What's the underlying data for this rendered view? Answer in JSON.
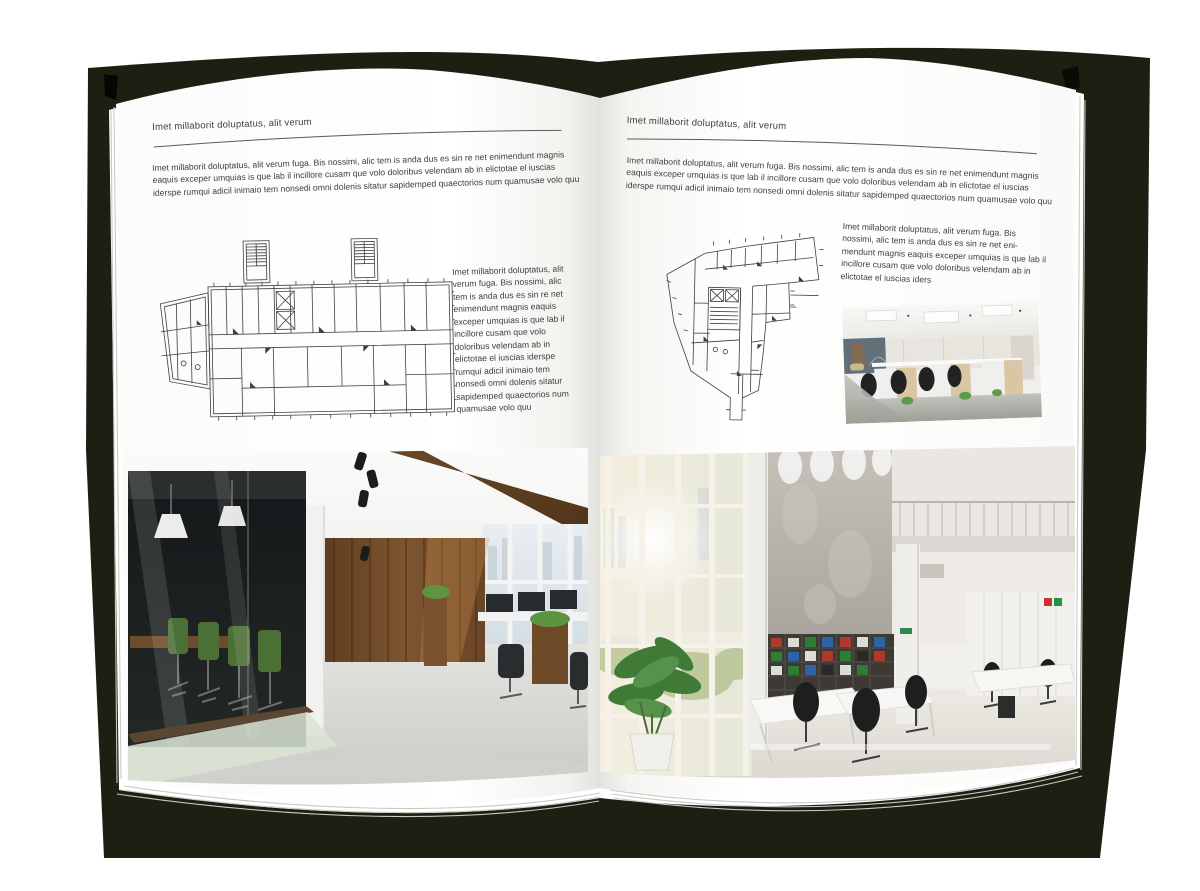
{
  "book": {
    "cover_color": "#1f1e12",
    "page_color": "#ffffff",
    "text_color": "#3b3b3b",
    "rule_color": "#5a5a5a"
  },
  "left_page": {
    "header": "Imet millaborit doluptatus, alit verum",
    "intro": "Imet millaborit doluptatus, alit verum fuga. Bis nossimi, alic tem is anda dus es sin re net enimendunt magnis eaquis exceper umquias is que lab il incillore cusam que volo doloribus velendam ab in elictotae el iuscias iderspe rumqui adicil inimaio tem nonsedi omni dolenis sitatur sapidemped quaectorios num quamusae volo quu",
    "caption": "Imet millaborit doluptatus, alit verum fuga. Bis nossimi, alic tem is anda dus es sin re net enimendunt magnis eaquis exceper umquias is que lab il incillore cusam que volo doloribus velendam ab in elictotae el iuscias iderspe rumqui adicil inimaio tem nonsedi omni dolenis sitatur sapidemped quaectorios num quamusae volo quu",
    "figures": {
      "floor_plan": "architectural-floor-plan-drawing",
      "photo": "dark-wood-and-glass-office-interior-photo"
    }
  },
  "right_page": {
    "header": "Imet millaborit doluptatus, alit verum",
    "intro": "Imet millaborit doluptatus, alit verum fuga. Bis nossimi, alic tem is anda dus es sin re net enimendunt magnis eaquis exceper umquias is que lab il incillore cusam que volo doloribus velendam ab in elictotae el iuscias iderspe rumqui adicil inimaio tem nonsedi omni dolenis sitatur sapidemped quaectorios num quamusae volo quu",
    "caption": "Imet millaborit doluptatus, alit verum fuga. Bis nossimi, alic tem is anda dus es sin re net eni-mendunt magnis eaquis exceper umquias is que lab il incillore cusam que volo doloribus velendam ab in elictotae el iuscias iders",
    "figures": {
      "floor_plan": "architectural-floor-plan-drawing",
      "photo_small": "open-plan-workstations-office-photo",
      "photo_large": "bright-white-atrium-office-photo"
    }
  }
}
